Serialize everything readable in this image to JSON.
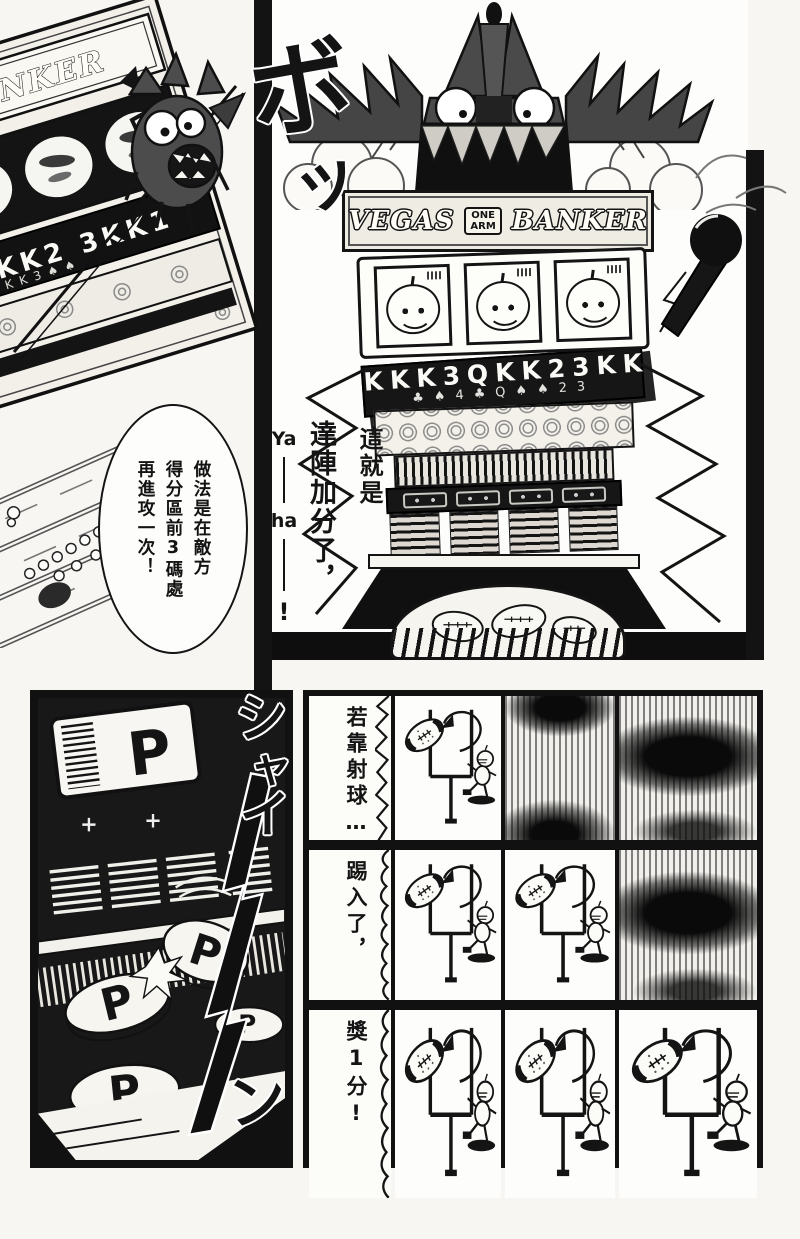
{
  "sfx": {
    "burst": [
      "ボ",
      "ッ"
    ],
    "shine": [
      "シ",
      "ャ",
      "イ",
      "ー",
      "ン"
    ]
  },
  "left_machine": {
    "banner": "BANKER",
    "cards": "KK2 3KK1",
    "cards_small": "KK3♠♠"
  },
  "bubble": {
    "text": "做法是在敵方\n得分區前3碼處\n再進攻一次！"
  },
  "big_panel": {
    "caption": "另外還有得分機會！\n獎分遊戲！",
    "speech": {
      "c1": "這就是",
      "c2": "達陣加分了，",
      "ya": "Ya",
      "ha": "ha",
      "bang": "!"
    },
    "machine": {
      "banner": [
        "VEGAS",
        "ONE",
        "ARM",
        "BANKER"
      ],
      "cards": "KKK3QKK23KK",
      "suits": "♣♠4♣Q♠♠23"
    }
  },
  "coin_panel": {
    "letter": "P"
  },
  "bottom_rows": [
    {
      "label": "若靠射球…",
      "cells": [
        "goal",
        "dark-tb",
        "dark-mid"
      ]
    },
    {
      "label": "踢入了，",
      "cells": [
        "goal",
        "goal",
        "dark-mid"
      ]
    },
    {
      "label": "獎1分!",
      "cells": [
        "goal",
        "goal",
        "goal"
      ]
    }
  ]
}
